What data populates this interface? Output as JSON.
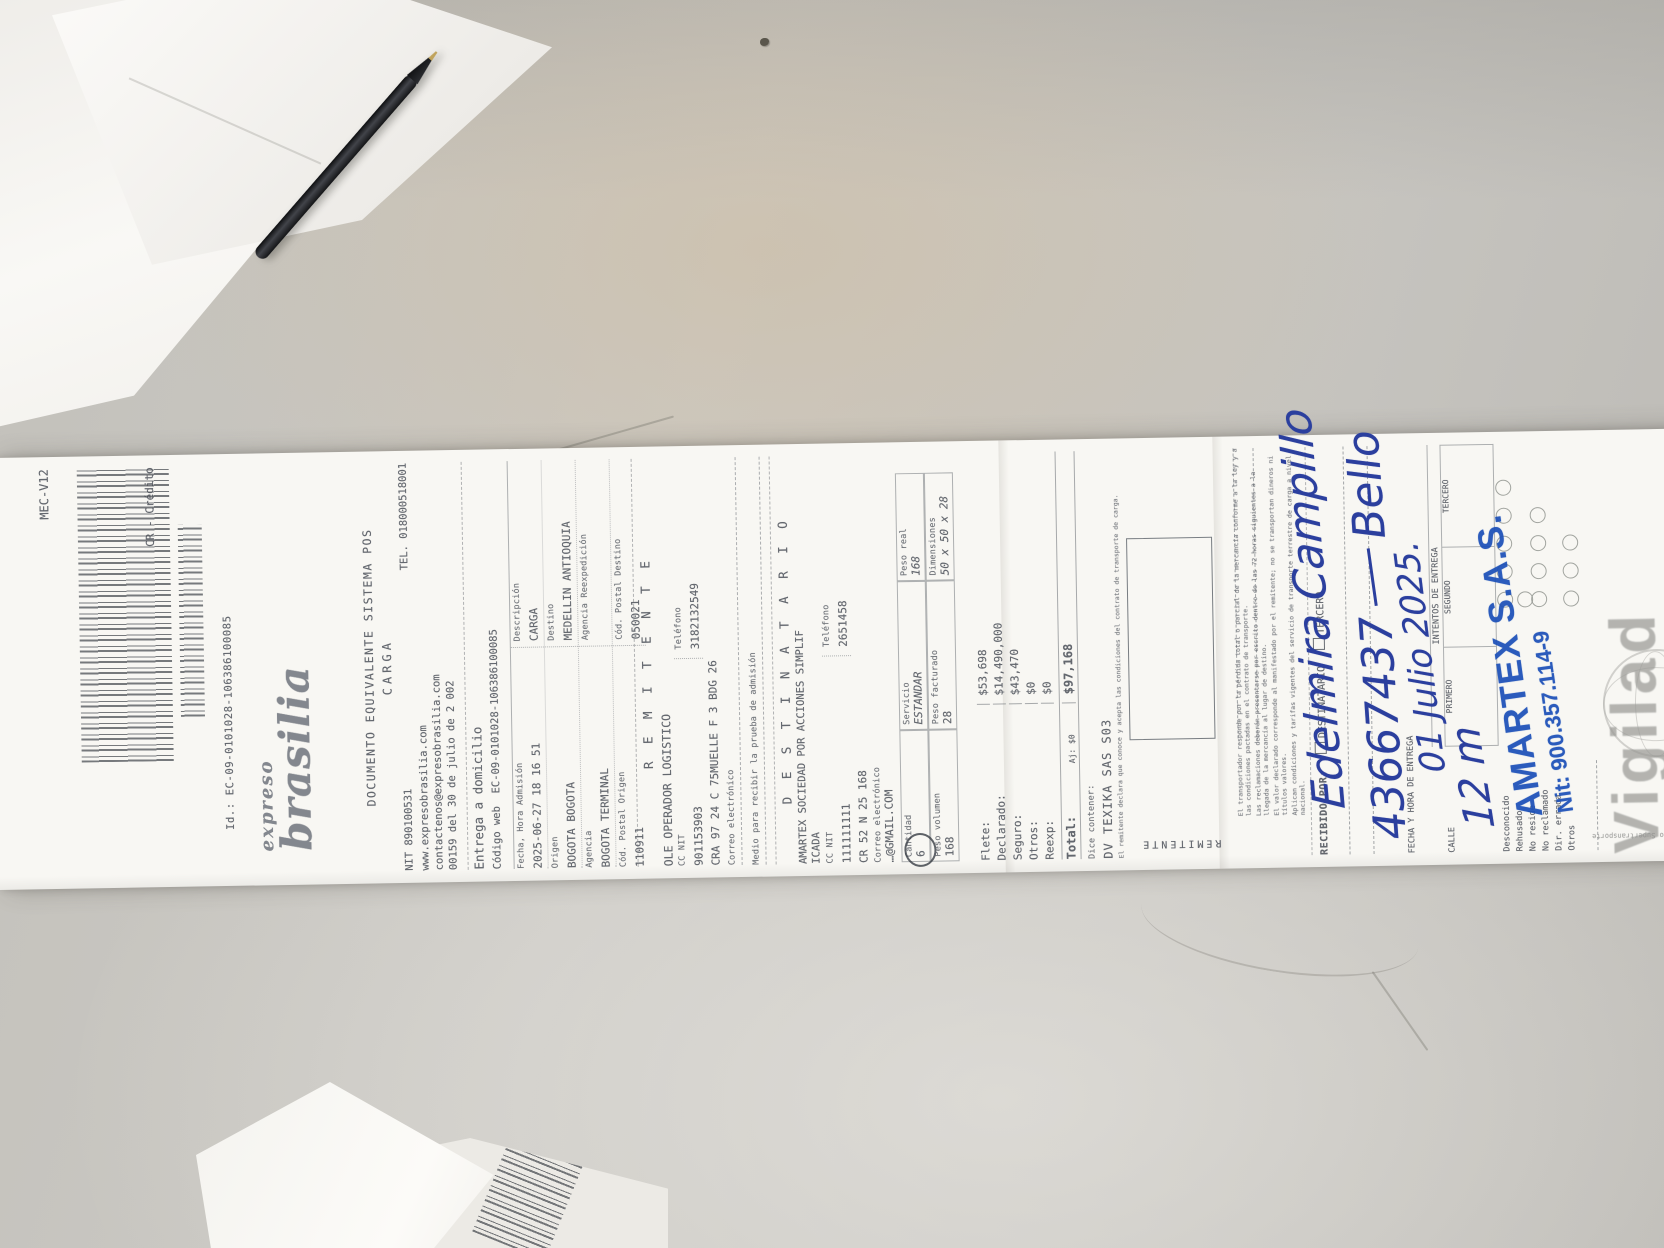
{
  "colors": {
    "desk": "#c7c4be",
    "paper": "#f8f7f3",
    "ink_gray": "#63676e",
    "stamp_blue": "#1c50b8",
    "handwriting_blue": "#2b3f9e",
    "watermark_gray": "#9a9a96"
  },
  "receipt": {
    "header": {
      "form_code": "MEC-V12",
      "payment": "CR - Crédito",
      "id_line": "Id.: EC-09-0101028-106386100085",
      "brand_top": "expreso",
      "brand_main": "brasilia",
      "doc_title": "DOCUMENTO EQUIVALENTE SISTEMA POS",
      "doc_subtitle": "CARGA",
      "nit": "NIT 890100531",
      "tel": "TEL. 018000518001",
      "web": "www.expresobrasilia.com",
      "email": "contactenos@expresobrasilia.com",
      "resolution": "00159 del 30 de julio de 2 002",
      "delivery_mode": "Entrega a domicilio",
      "codigo_web_label": "Código web",
      "codigo_web_value": "EC-09-0101028-106386100085"
    },
    "admission": {
      "rows": [
        {
          "l_label": "Fecha, Hora Admisión",
          "l_value": "2025-06-27 18 16 51",
          "r_label": "Descripción",
          "r_value": "CARGA"
        },
        {
          "l_label": "Origen",
          "l_value": "BOGOTA BOGOTA",
          "r_label": "Destino",
          "r_value": "MEDELLIN ANTIOQUIA"
        },
        {
          "l_label": "Agencia",
          "l_value": "BOGOTA TERMINAL",
          "r_label": "Agencia Reexpedición",
          "r_value": ""
        },
        {
          "l_label": "Cód. Postal Origen",
          "l_value": "110911",
          "r_label": "Cód. Postal Destino",
          "r_value": "050021"
        }
      ]
    },
    "remitente": {
      "title": "R E M I T E N T E",
      "name": "OLE OPERADOR LOGISTICO",
      "cc_label": "CC  NIT",
      "cc_value": "901153903",
      "tel_label": "Teléfono",
      "tel_value": "3182132549",
      "address": "CRA 97 24 C 75MUELLE F 3 BDG 26",
      "correo_label": "Correo electrónico",
      "medio_label": "Medio para recibir la prueba de admisión"
    },
    "destinatario": {
      "title": "D E S T I N A T A R I O",
      "name_line1": "AMARTEX SOCIEDAD POR ACCIONES SIMPLIF",
      "name_line2": "ICADA",
      "cc_label": "CC  NIT",
      "cc_value": "111111111",
      "tel_label": "Teléfono",
      "tel_value": "2651458",
      "address": "CR 52 N 25 168",
      "correo_label": "Correo electrónico",
      "correo_value": "…@GMAIL.COM"
    },
    "shipment": {
      "cantidad_label": "Cantidad",
      "cantidad_value": "6",
      "servicio_label": "Servicio",
      "servicio_value": "ESTANDAR",
      "peso_real_label": "Peso real",
      "peso_real_value": "168",
      "volumen_label": "Peso volumen",
      "volumen_value": "168",
      "facturado_label": "Peso facturado",
      "facturado_value": "28",
      "dim_label": "Dimensiones",
      "dim_value": "50 x 50 x 28"
    },
    "amounts": {
      "rows": [
        {
          "label": "Flete:",
          "value": "$53,698"
        },
        {
          "label": "Declarado:",
          "value": "$14,490,000"
        },
        {
          "label": "Seguro:",
          "value": "$43,470"
        },
        {
          "label": "Otros:",
          "value": "$0"
        },
        {
          "label": "Reexp:",
          "value": "$0"
        }
      ],
      "total_label": "Total:",
      "total_aj": "Aj: $0",
      "total_value": "$97,168"
    },
    "contents": {
      "label": "Dice contener:",
      "value": "DV TEXIKA SAS S03"
    },
    "fine_print_1": "El remitente declara que conoce y acepta las condiciones del contrato de transporte de carga.",
    "terms_lines": [
      "El transportador responde por la pérdida total o parcial de la mercancía conforme a la ley y a las condiciones pactadas en el contrato de transporte.",
      "Las reclamaciones deberán presentarse por escrito dentro de las 72 horas siguientes a la llegada de la mercancía al lugar de destino.",
      "El valor declarado corresponde al manifestado por el remitente; no se transportan dineros ni títulos valores.",
      "Aplican condiciones y tarifas vigentes del servicio de transporte terrestre de carga a nivel nacional."
    ],
    "signature_section": {
      "remitente_flipped": "REMITENTE"
    },
    "delivery": {
      "recibido_label": "RECIBIDO POR:",
      "opt1": "DESTINATARIO",
      "opt2": "TERCERO",
      "fecha_label": "FECHA Y HORA DE ENTREGA",
      "calle_label": "CALLE",
      "intentos_label": "INTENTOS DE ENTREGA",
      "attempt_cols": [
        "PRIMERO",
        "SEGUNDO",
        "TERCERO"
      ],
      "reasons": [
        "Desconocido",
        "Rehusado",
        "No reside",
        "No reclamado",
        "Dir. errada",
        "Otros"
      ]
    },
    "handwriting": {
      "name": "Edelmira Campillo",
      "id_number": "43667437",
      "city": "Bello",
      "date": "01 Julio 2025.",
      "attempt_note": "12 m"
    },
    "stamp": {
      "name": "AMARTEX S.A.S.",
      "nit": "Nit: 900.357.114-9"
    },
    "watermark": {
      "text": "Vigilad",
      "side_text": "Vigilado Supertransporte"
    }
  },
  "corner_receipt": {
    "form_code": "MEC-V12"
  }
}
